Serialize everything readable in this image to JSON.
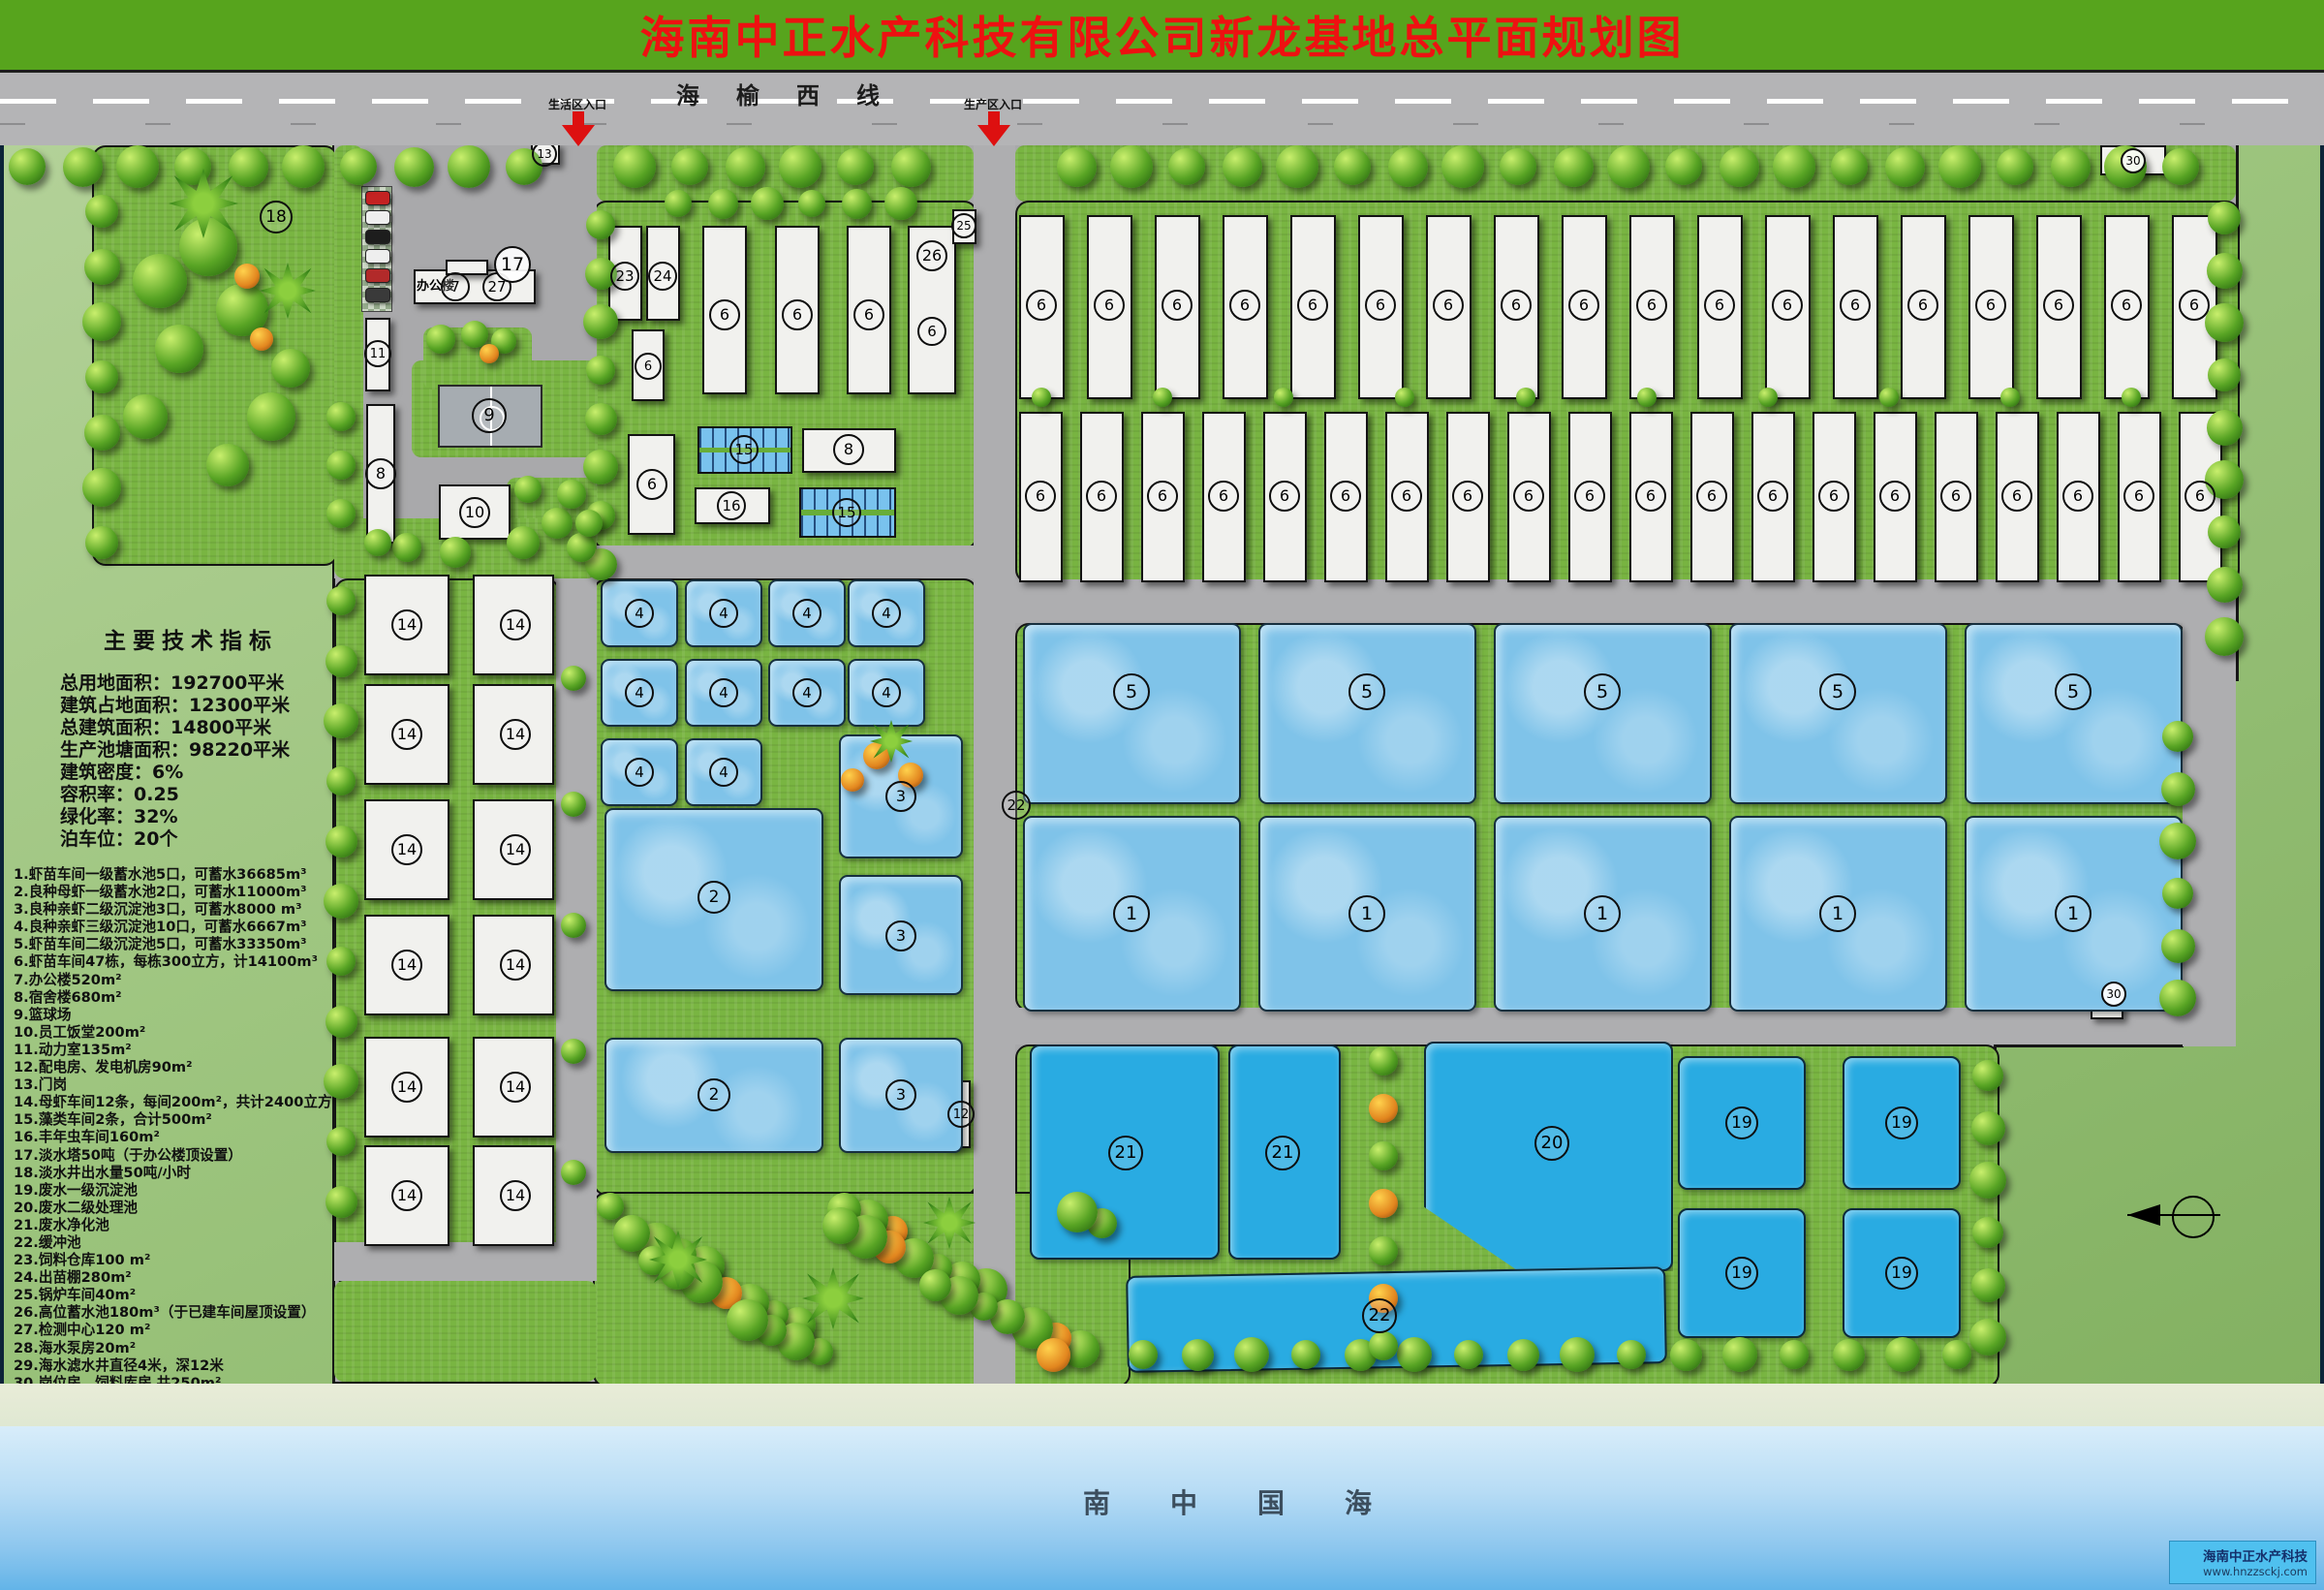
{
  "title": "海南中正水产科技有限公司新龙基地总平面规划图",
  "highway": {
    "name": "海榆西线",
    "entrance_living": "生活区入口",
    "entrance_production": "生产区入口"
  },
  "tech_indicators": {
    "title": "主要技术指标",
    "lines": [
      "总用地面积：192700平米",
      "建筑占地面积：12300平米",
      "总建筑面积：14800平米",
      "生产池塘面积：98220平米",
      "建筑密度：6%",
      "容积率：0.25",
      "绿化率：32%",
      "泊车位：20个"
    ]
  },
  "legend": [
    "1.虾苗车间一级蓄水池5口，可蓄水36685m³",
    "2.良种母虾一级蓄水池2口，可蓄水11000m³",
    "3.良种亲虾二级沉淀池3口，可蓄水8000 m³",
    "4.良种亲虾三级沉淀池10口，可蓄水6667m³",
    "5.虾苗车间二级沉淀池5口，可蓄水33350m³",
    "6.虾苗车间47栋，每栋300立方，计14100m³",
    "7.办公楼520m²",
    "8.宿舍楼680m²",
    "9.篮球场",
    "10.员工饭堂200m²",
    "11.动力室135m²",
    "12.配电房、发电机房90m²",
    "13.门岗",
    "14.母虾车间12条，每间200m²，共计2400立方",
    "15.藻类车间2条，合计500m²",
    "16.丰年虫车间160m²",
    "17.淡水塔50吨（于办公楼顶设置）",
    "18.淡水井出水量50吨/小时",
    "19.废水一级沉淀池",
    "20.废水二级处理池",
    "21.废水净化池",
    "22.缓冲池",
    "23.饲料仓库100 m²",
    "24.出苗棚280m²",
    "25.锅炉车间40m²",
    "26.高位蓄水池180m³（于已建车间屋顶设置）",
    "27.检测中心120 m²",
    "28.海水泵房20m²",
    "29.海水滤水井直径4米，深12米",
    "30.岗位房、饲料库房 共250m²"
  ],
  "map": {
    "office_label": "办公楼",
    "numbers": [
      "1",
      "2",
      "3",
      "4",
      "5",
      "6",
      "7",
      "8",
      "9",
      "10",
      "11",
      "12",
      "13",
      "14",
      "15",
      "16",
      "17",
      "18",
      "19",
      "20",
      "21",
      "22",
      "23",
      "24",
      "25",
      "26",
      "27",
      "28",
      "29",
      "30"
    ]
  },
  "sea": {
    "label": "南中国海"
  },
  "footer": {
    "company": "海南中正水产科技",
    "website": "www.hnzzsckj.com"
  }
}
